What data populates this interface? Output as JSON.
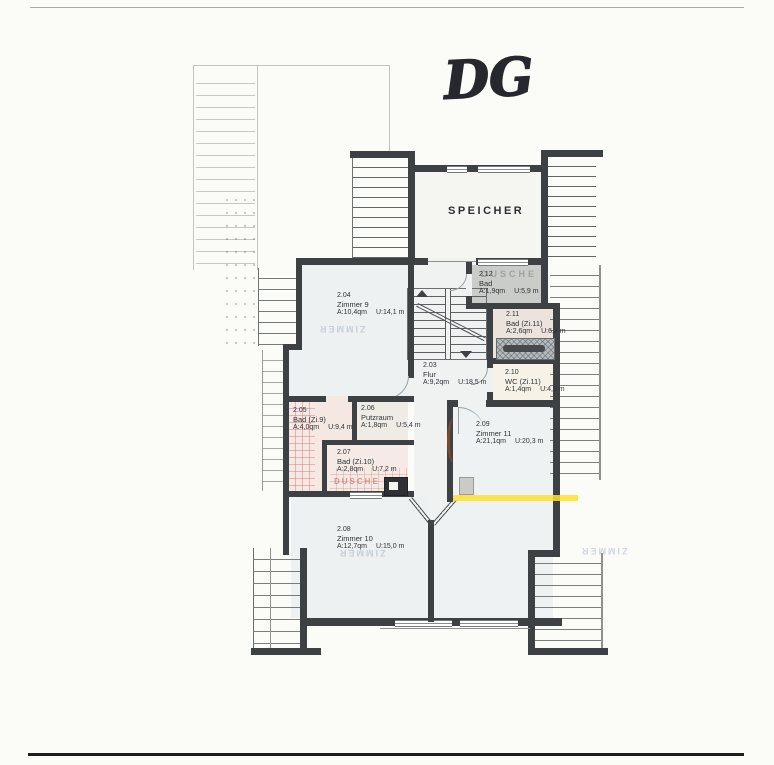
{
  "title": "DG",
  "floor_plan": {
    "attic_room_label": "SPEICHER",
    "rooms": [
      {
        "id": "2.04",
        "name": "Zimmer 9",
        "area": "A:10,4qm",
        "perimeter": "U:14,1 m"
      },
      {
        "id": "2.12",
        "name": "Bad",
        "area": "A:1,9qm",
        "perimeter": "U:5,9 m"
      },
      {
        "id": "2.11",
        "name": "Bad (Zi.11)",
        "area": "A:2,6qm",
        "perimeter": "U:6,4 m"
      },
      {
        "id": "2.03",
        "name": "Flur",
        "area": "A:9,2qm",
        "perimeter": "U:18,5 m"
      },
      {
        "id": "2.10",
        "name": "WC (Zi.11)",
        "area": "A:1,4qm",
        "perimeter": "U:4,9 m"
      },
      {
        "id": "2.05",
        "name": "Bad (Zi.9)",
        "area": "A:4,0qm",
        "perimeter": "U:9,4 m"
      },
      {
        "id": "2.06",
        "name": "Putzraum",
        "area": "A:1,8qm",
        "perimeter": "U:5,4 m"
      },
      {
        "id": "2.07",
        "name": "Bad (Zi.10)",
        "area": "A:2,8qm",
        "perimeter": "U:7,2 m"
      },
      {
        "id": "2.09",
        "name": "Zimmer 11",
        "area": "A:21,1qm",
        "perimeter": "U:20,3 m"
      },
      {
        "id": "2.08",
        "name": "Zimmer 10",
        "area": "A:12,7qm",
        "perimeter": "U:15,0 m"
      }
    ],
    "watermarks": {
      "shower_gray": "DUSCHE",
      "shower_red": "DUSCHE",
      "bleedthrough": "ZIMMER"
    },
    "colors": {
      "wall": "#3e4144",
      "room_fill": "#eef1f1",
      "bath_pink": "#f5e7e2",
      "bad_212_gray": "#c9ccc8",
      "wc_cream": "#f6f2e8",
      "highlight_yellow": "#ffe02e"
    }
  }
}
